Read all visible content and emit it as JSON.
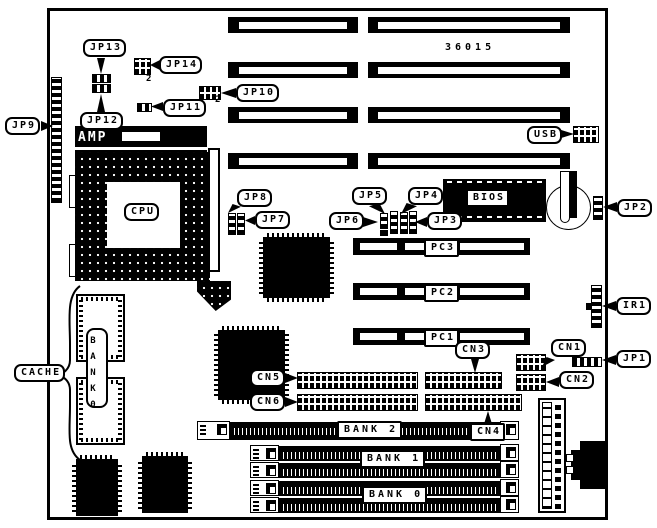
{
  "board": {
    "part_number": "36015",
    "pin2_marker": "2"
  },
  "colors": {
    "ink": "#000000",
    "paper": "#ffffff"
  },
  "labels": {
    "jp1": "JP1",
    "jp2": "JP2",
    "jp3": "JP3",
    "jp4": "JP4",
    "jp5": "JP5",
    "jp6": "JP6",
    "jp7": "JP7",
    "jp8": "JP8",
    "jp9": "JP9",
    "jp10": "JP10",
    "jp11": "JP11",
    "jp12": "JP12",
    "jp13": "JP13",
    "jp14": "JP14",
    "cn1": "CN1",
    "cn2": "CN2",
    "cn3": "CN3",
    "cn4": "CN4",
    "cn5": "CN5",
    "cn6": "CN6",
    "pc1": "PC1",
    "pc2": "PC2",
    "pc3": "PC3",
    "ir1": "IR1",
    "usb": "USB",
    "bios": "BIOS",
    "cpu": "CPU",
    "amp": "AMP",
    "cache": "CACHE",
    "bank0": "BANK 0",
    "bank1": "BANK 1",
    "bank2": "BANK 2",
    "bank0_chip": "BANK0"
  }
}
